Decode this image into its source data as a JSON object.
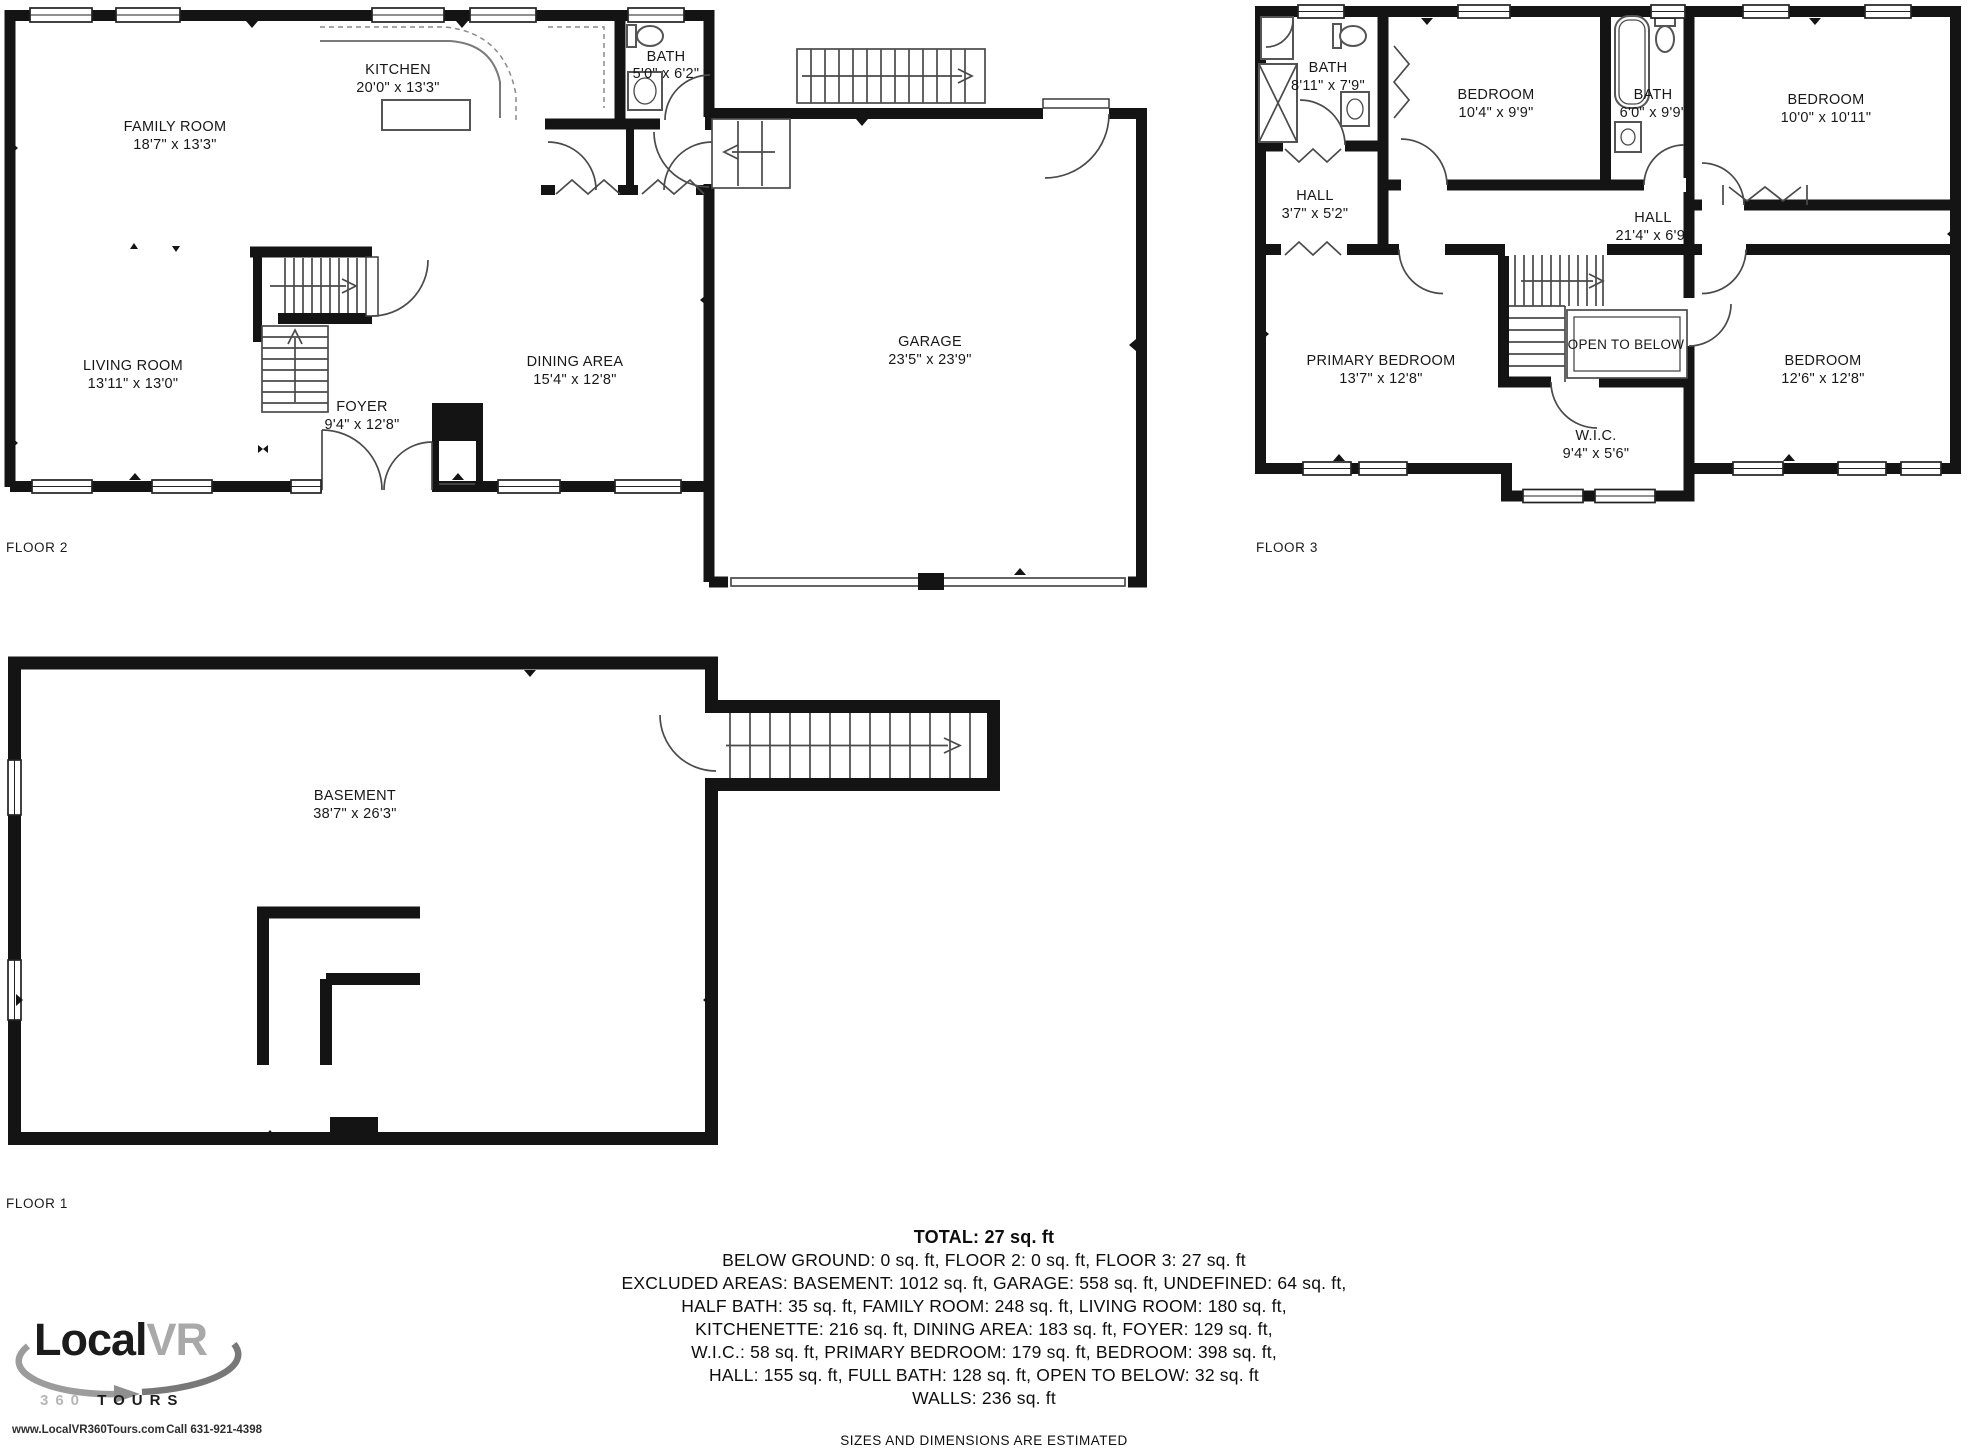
{
  "floors": {
    "floor2": {
      "label": "FLOOR 2",
      "rooms": {
        "family_room": {
          "name": "FAMILY ROOM",
          "dims": "18'7\" x 13'3\""
        },
        "kitchen": {
          "name": "KITCHEN",
          "dims": "20'0\" x 13'3\""
        },
        "bath": {
          "name": "BATH",
          "dims": "5'0\" x 6'2\""
        },
        "living_room": {
          "name": "LIVING ROOM",
          "dims": "13'11\" x 13'0\""
        },
        "foyer": {
          "name": "FOYER",
          "dims": "9'4\" x 12'8\""
        },
        "dining_area": {
          "name": "DINING AREA",
          "dims": "15'4\" x 12'8\""
        },
        "garage": {
          "name": "GARAGE",
          "dims": "23'5\" x 23'9\""
        }
      }
    },
    "floor3": {
      "label": "FLOOR 3",
      "rooms": {
        "bath_upper_left": {
          "name": "BATH",
          "dims": "8'11\" x 7'9\""
        },
        "hall_small": {
          "name": "HALL",
          "dims": "3'7\" x 5'2\""
        },
        "bedroom_top": {
          "name": "BEDROOM",
          "dims": "10'4\" x 9'9\""
        },
        "bath_center": {
          "name": "BATH",
          "dims": "6'0\" x 9'9\""
        },
        "bedroom_right": {
          "name": "BEDROOM",
          "dims": "10'0\" x 10'11\""
        },
        "hall": {
          "name": "HALL",
          "dims": "21'4\" x 6'9\""
        },
        "primary_bedroom": {
          "name": "PRIMARY BEDROOM",
          "dims": "13'7\" x 12'8\""
        },
        "open_to_below": {
          "name": "OPEN TO BELOW"
        },
        "wic": {
          "name": "W.I.C.",
          "dims": "9'4\" x 5'6\""
        },
        "bedroom_lower": {
          "name": "BEDROOM",
          "dims": "12'6\" x 12'8\""
        }
      }
    },
    "floor1": {
      "label": "FLOOR 1",
      "rooms": {
        "basement": {
          "name": "BASEMENT",
          "dims": "38'7\" x 26'3\""
        }
      }
    }
  },
  "summary": {
    "total": "TOTAL: 27 sq. ft",
    "lines": [
      "BELOW GROUND: 0 sq. ft, FLOOR 2: 0 sq. ft, FLOOR 3: 27 sq. ft",
      "EXCLUDED AREAS: BASEMENT: 1012 sq. ft, GARAGE: 558 sq. ft, UNDEFINED: 64 sq. ft,",
      "HALF BATH: 35 sq. ft, FAMILY ROOM: 248 sq. ft, LIVING ROOM: 180 sq. ft,",
      "KITCHENETTE: 216 sq. ft, DINING AREA: 183 sq. ft, FOYER: 129 sq. ft,",
      "W.I.C.: 58 sq. ft, PRIMARY BEDROOM: 179 sq. ft, BEDROOM: 398 sq. ft,",
      "HALL: 155 sq. ft, FULL BATH: 128 sq. ft, OPEN TO BELOW: 32 sq. ft",
      "WALLS: 236 sq. ft"
    ],
    "disclaimer": "SIZES AND DIMENSIONS ARE ESTIMATED"
  },
  "logo": {
    "brand_local": "Local",
    "brand_vr": "VR",
    "tagline_360": "360",
    "tagline_tours": "TOURS",
    "website": "www.LocalVR360Tours.com",
    "phone": "Call 631-921-4398"
  },
  "colors": {
    "wall": "#141414",
    "thin_line": "#4a4a4a",
    "logo_gray": "#a9a9a9"
  }
}
